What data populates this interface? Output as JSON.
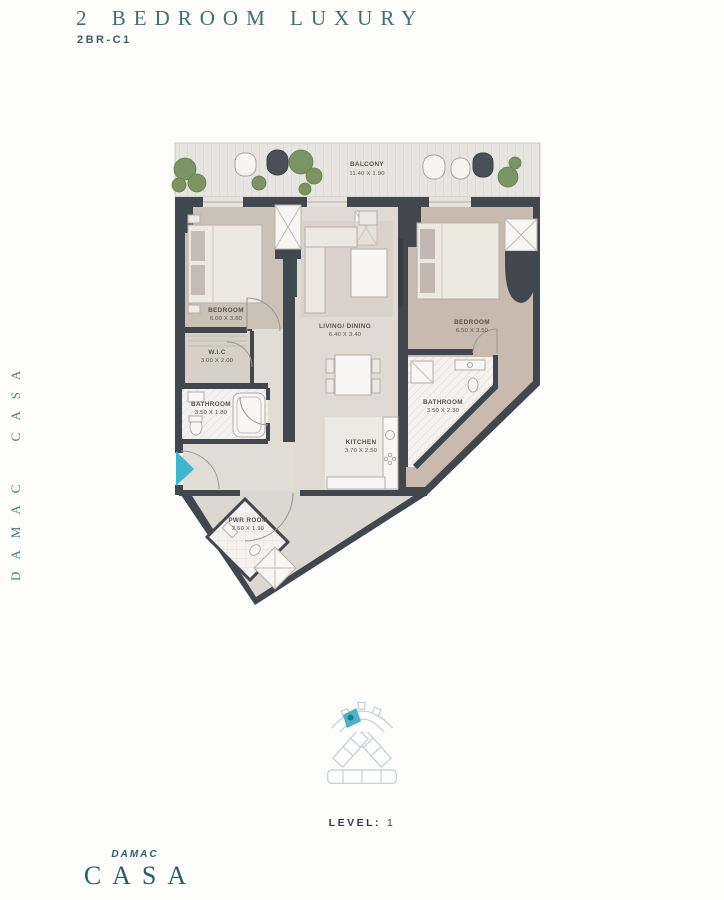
{
  "header": {
    "title": "2 BEDROOM LUXURY",
    "subtitle": "2BR-C1"
  },
  "side_text": "DAMAC CASA",
  "floorplan": {
    "rooms": {
      "balcony": {
        "name": "BALCONY",
        "dims": "11.40 X 1.90"
      },
      "bedroom1": {
        "name": "BEDROOM",
        "dims": "6.00 X 3.60"
      },
      "wic": {
        "name": "W.I.C",
        "dims": "3.00 X 2.00"
      },
      "bathroom1": {
        "name": "BATHROOM",
        "dims": "3.50 X 1.80"
      },
      "living": {
        "name": "LIVING/ DINING",
        "dims": "6.40 X 3.40"
      },
      "kitchen": {
        "name": "KITCHEN",
        "dims": "3.70 X 2.50"
      },
      "bedroom2": {
        "name": "BEDROOM",
        "dims": "6.50 X 3.50"
      },
      "bathroom2": {
        "name": "BATHROOM",
        "dims": "3.50 X 2.30"
      },
      "pwr_room": {
        "name": "PWR ROOM",
        "dims": "2.50 X 1.90"
      }
    }
  },
  "keyplan": {
    "level_label": "LEVEL:",
    "level_value": "1"
  },
  "logo": {
    "brand": "DAMAC",
    "name": "CASA"
  },
  "colors": {
    "accent_teal": "#41706E",
    "logo_teal": "#2B5F68",
    "wall": "#42474E",
    "entry_arrow_cyan": "#3BB7CE",
    "keyplan_highlight": "#3FA9C5"
  }
}
